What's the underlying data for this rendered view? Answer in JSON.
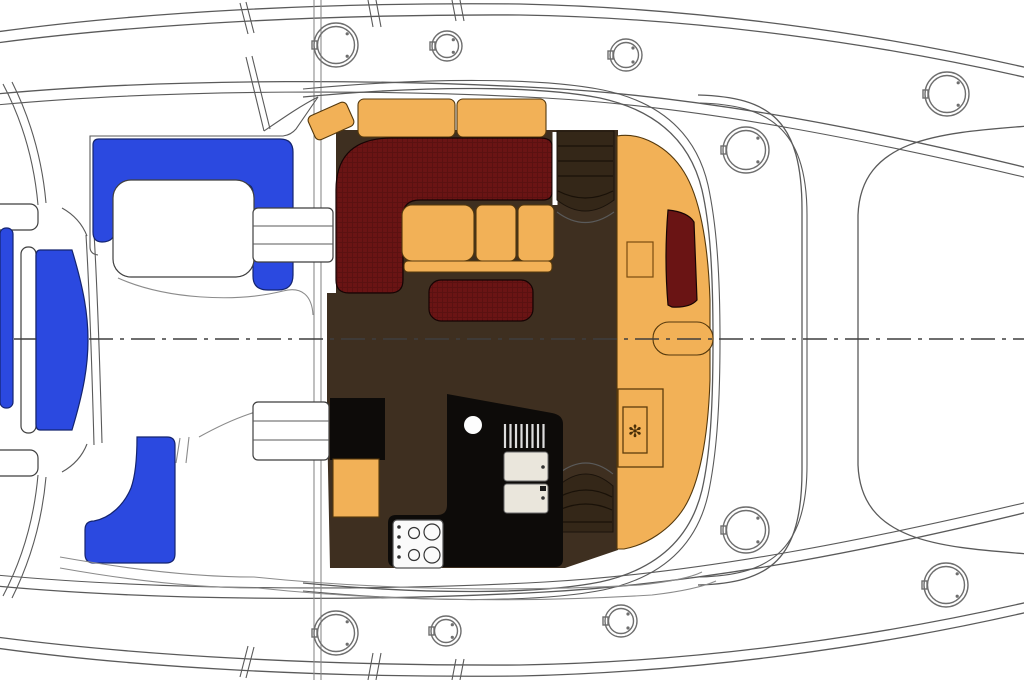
{
  "plan": {
    "description": "catamaran-saloon-deck-plan",
    "colors": {
      "hull_line": "#5a5a5a",
      "hatch_gray": "#6e6e6e",
      "cushion_blue": "#2b49e0",
      "upholstery_orange": "#f2b157",
      "upholstery_maroon": "#6a1414",
      "floor_brown": "#3e2f20",
      "console_brown": "#342718",
      "counter_black": "#0d0b09",
      "fridge_cream": "#eae6dc",
      "centerline_gray": "#3f3f3f"
    },
    "centerline": {
      "y": 339,
      "dash_pattern": "24 7 4 7"
    },
    "icons": {
      "freezer_snowflake": "✻"
    },
    "hatches": [
      {
        "x": 336,
        "y": 45,
        "r": 22
      },
      {
        "x": 447,
        "y": 46,
        "r": 15
      },
      {
        "x": 626,
        "y": 55,
        "r": 16
      },
      {
        "x": 947,
        "y": 94,
        "r": 22
      },
      {
        "x": 746,
        "y": 150,
        "r": 23
      },
      {
        "x": 746,
        "y": 530,
        "r": 23
      },
      {
        "x": 946,
        "y": 585,
        "r": 22
      },
      {
        "x": 336,
        "y": 633,
        "r": 22
      },
      {
        "x": 446,
        "y": 631,
        "r": 15
      },
      {
        "x": 621,
        "y": 621,
        "r": 16
      }
    ]
  }
}
